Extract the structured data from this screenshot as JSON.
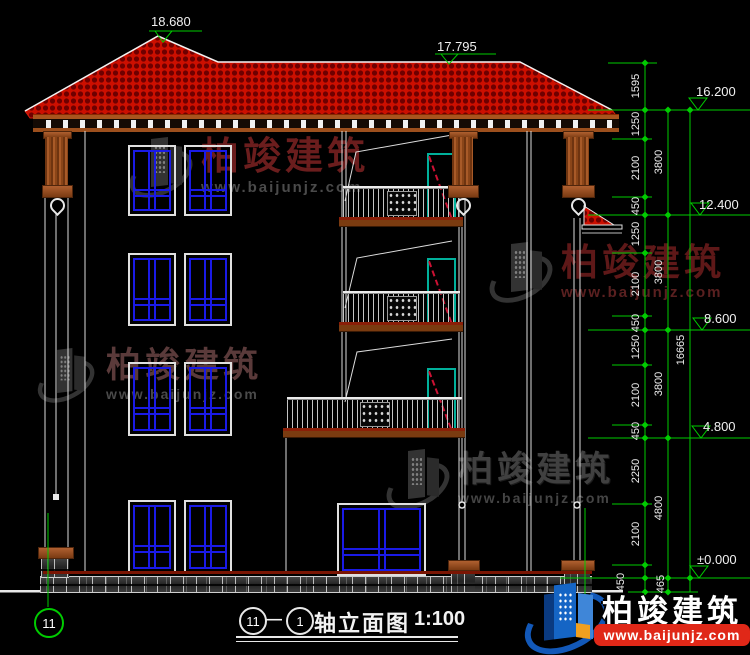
{
  "brand": {
    "name": "柏竣建筑",
    "url": "www.baijunjz.com"
  },
  "levels": {
    "roof_main": "18.680",
    "roof_secondary": "17.795",
    "eave": "16.200",
    "floor4": "12.400",
    "floor3": "8.600",
    "floor2": "4.800",
    "ground": "±0.000"
  },
  "dims": {
    "inner": [
      "1595",
      "1250",
      "2100",
      "450",
      "1250",
      "2100",
      "450",
      "1250",
      "2100",
      "450",
      "2250",
      "2100",
      "450"
    ],
    "floors": [
      "3800",
      "3800",
      "3800",
      "4800",
      "465"
    ],
    "total": "16665"
  },
  "axis": {
    "left_bubble": "11"
  },
  "title": {
    "bubble_left": "11",
    "dash": "—",
    "bubble_right": "1",
    "text": "轴立面图",
    "scale": "1:100"
  },
  "colors": {
    "roof_red": "#cc0f00",
    "roof_dark": "#6e0000",
    "line_green": "#00cc00",
    "window_blue": "#1a1ae6",
    "door_teal": "#00b09b",
    "accent_maroon": "#7a1503",
    "brand_red": "#e02818",
    "brand_blue": "#1565c5",
    "watermark_red": "#6b1d1d"
  }
}
